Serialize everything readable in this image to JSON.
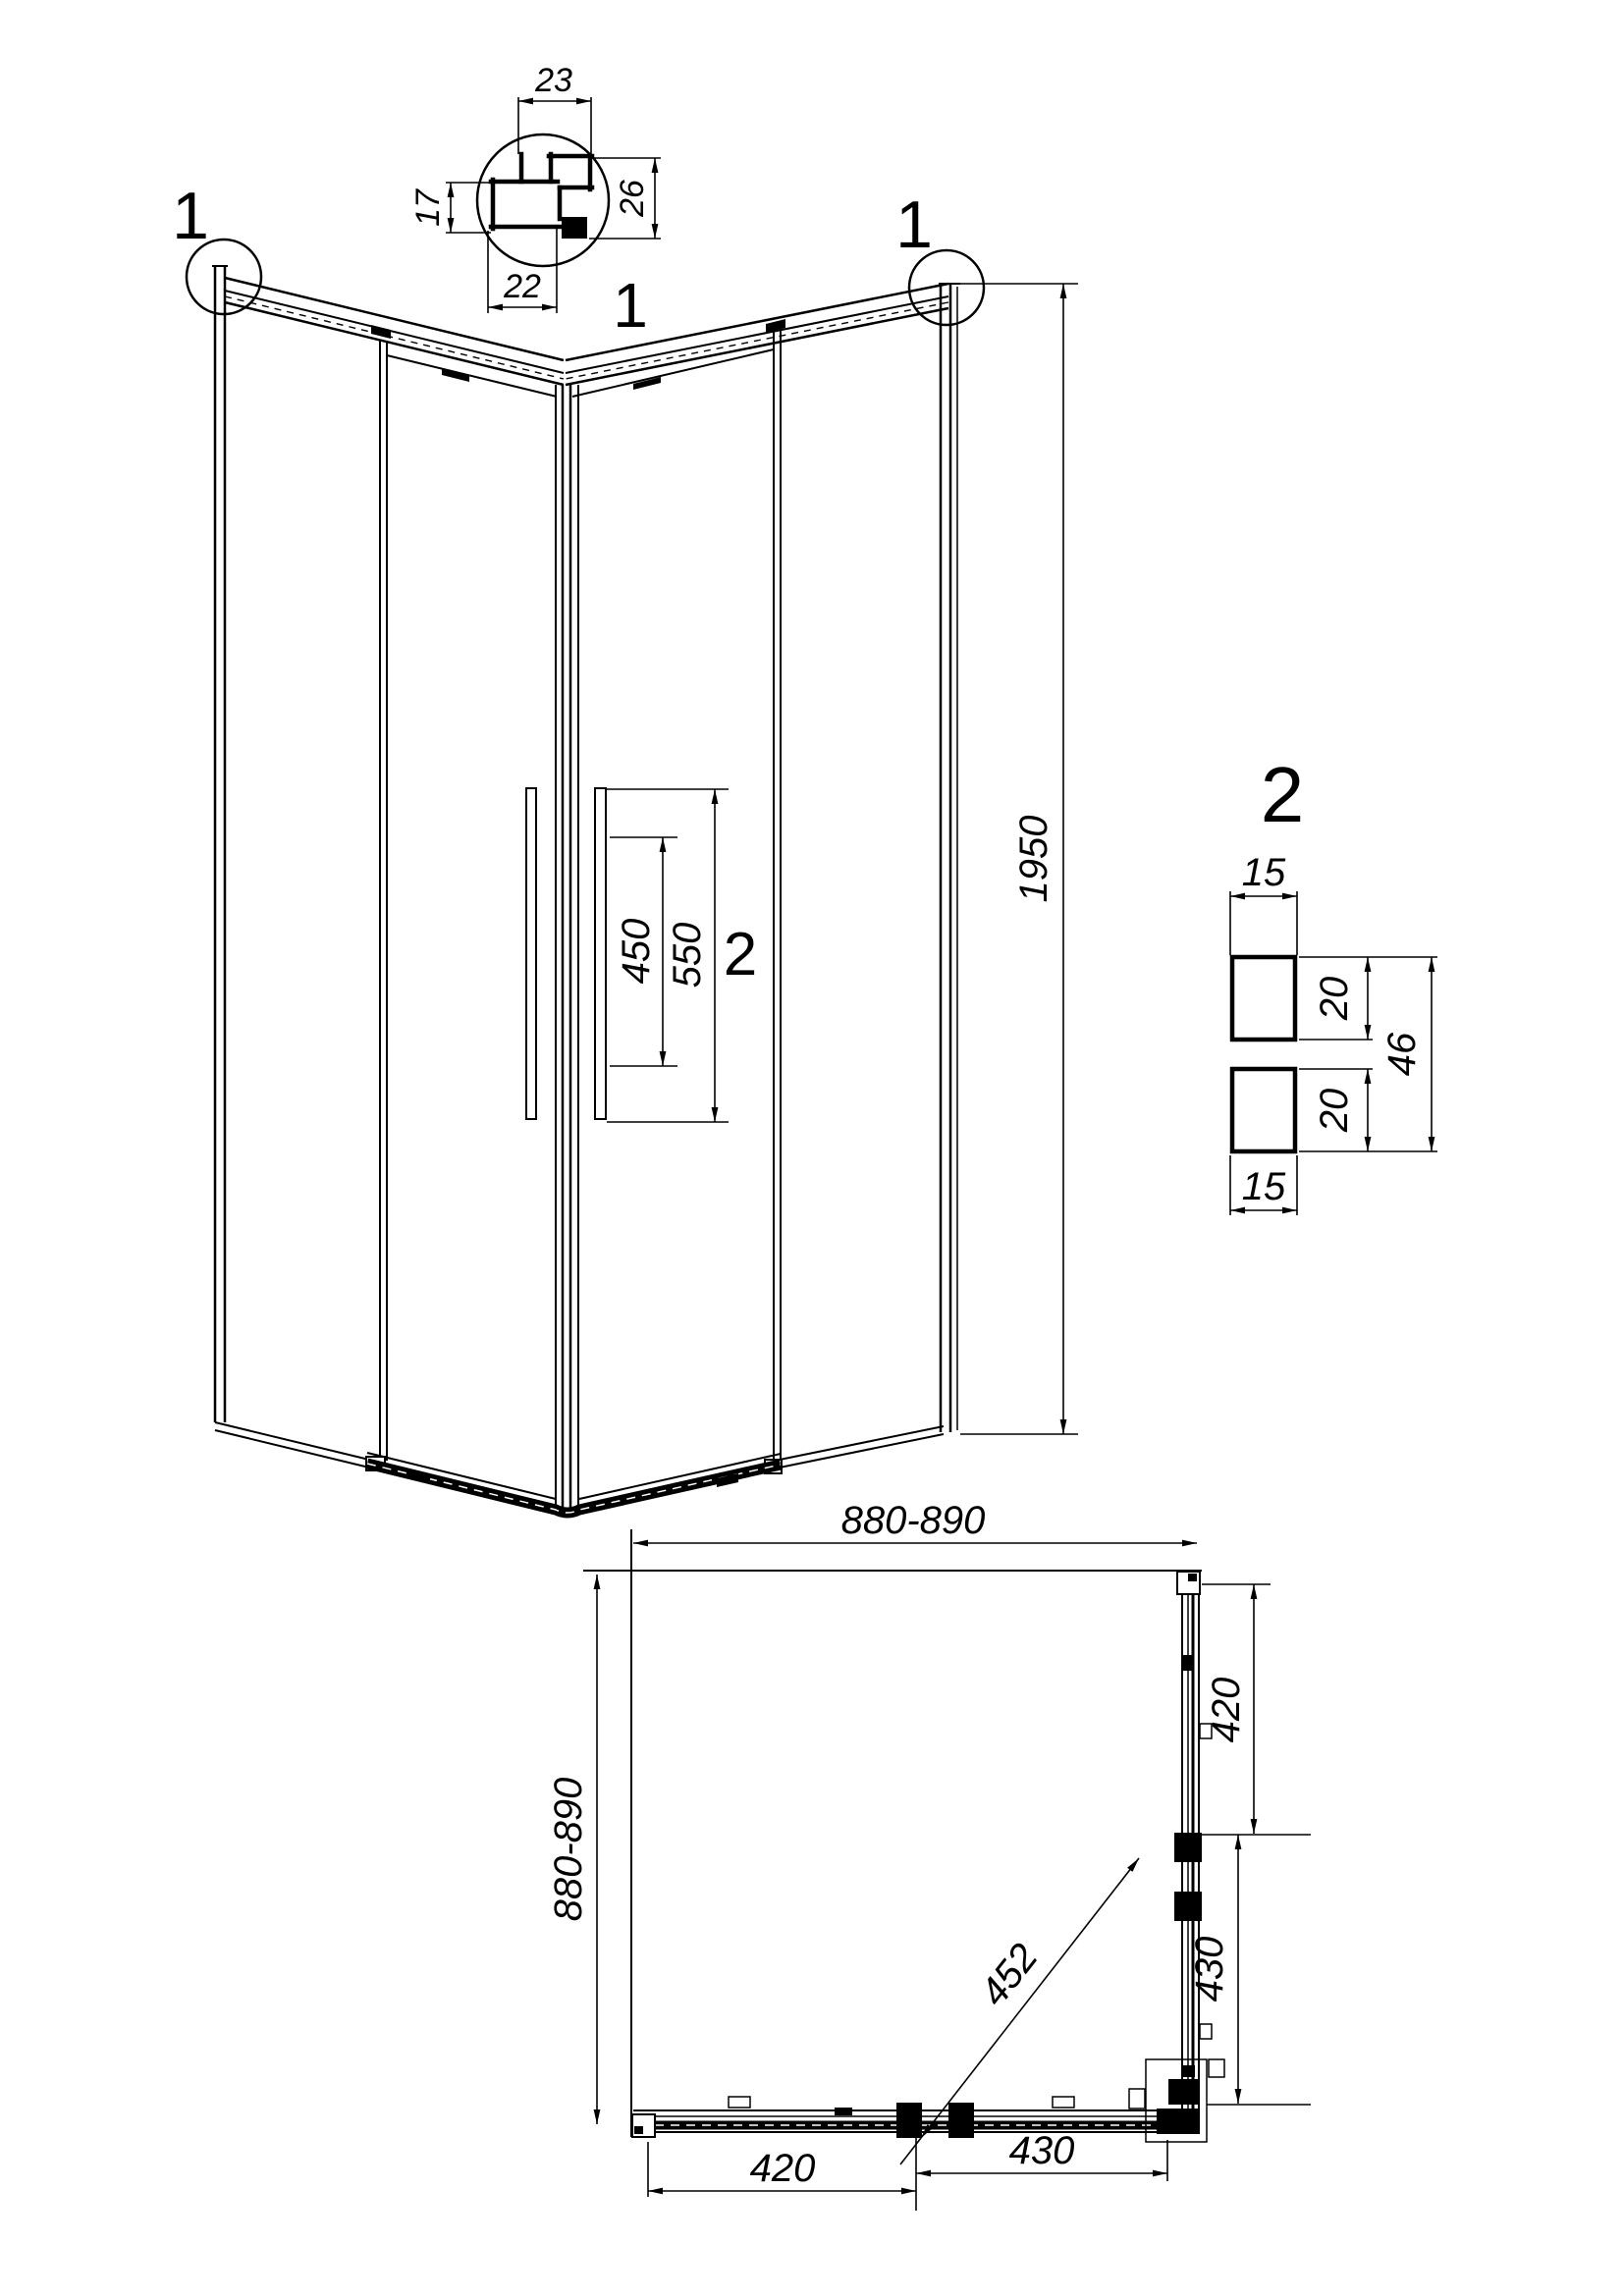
{
  "colors": {
    "line": "#000000",
    "background": "#ffffff"
  },
  "front_view": {
    "callout_left": "1",
    "callout_right": "1",
    "callout_profile_detail": "1",
    "callout_handle_detail": "2",
    "dim_handle_holes": "450",
    "dim_handle_length": "550",
    "dim_height": "1950"
  },
  "profile_detail": {
    "label": "1",
    "dim_top": "23",
    "dim_left": "17",
    "dim_right": "26",
    "dim_bottom": "22"
  },
  "handle_section_detail": {
    "label": "2",
    "dim_top_width": "15",
    "dim_upper_depth": "20",
    "dim_total_height": "46",
    "dim_lower_depth": "20",
    "dim_bottom_width": "15"
  },
  "plan_view": {
    "dim_width": "880-890",
    "dim_depth": "880-890",
    "dim_right_upper": "420",
    "dim_right_lower": "430",
    "dim_bottom_left": "420",
    "dim_bottom_right": "430",
    "dim_diagonal": "452"
  }
}
